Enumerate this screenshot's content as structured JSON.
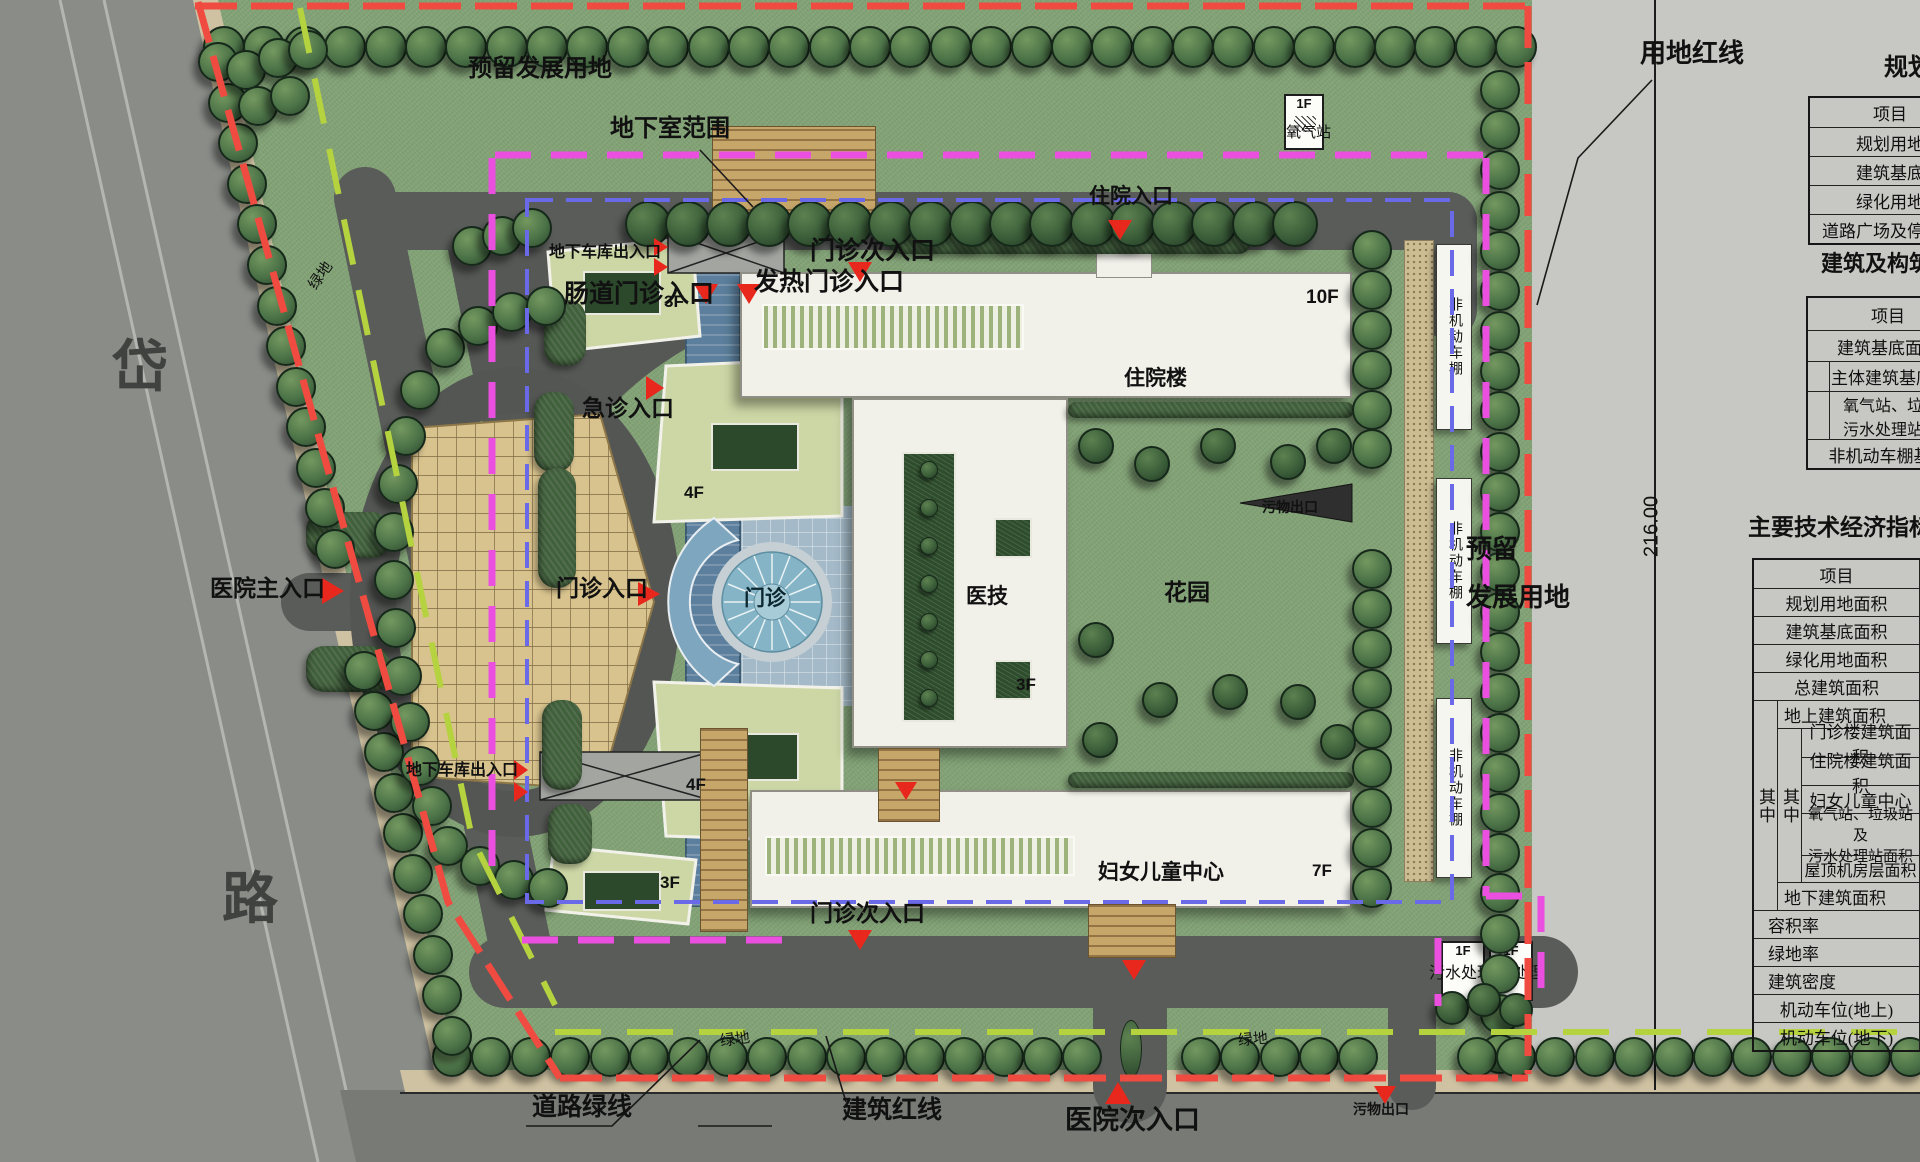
{
  "plan": {
    "road_name": {
      "char1": "岱",
      "char2": "路"
    },
    "boundary": {
      "reserved_top": "预留发展用地",
      "basement": "地下室范围",
      "red_line": "用地红线",
      "road_green_line": "道路绿线",
      "building_red_line": "建筑红线",
      "dimension": "216.00",
      "green_left": "绿地",
      "green_bottom_1": "绿地",
      "green_bottom_2": "绿地",
      "reserved_right_line1": "预留",
      "reserved_right_line2": "发展用地"
    },
    "entrances": {
      "main": "医院主入口",
      "outpatient": "门诊入口",
      "emergency": "急诊入口",
      "intestinal": "肠道门诊入口",
      "fever": "发热门诊入口",
      "outpatient_side_top": "门诊次入口",
      "outpatient_side_bottom": "门诊次入口",
      "inpatient": "住院入口",
      "secondary": "医院次入口",
      "garage_top": "地下车库出入口",
      "garage_left": "地下车库出入口",
      "waste_exit_mid": "污物出口",
      "waste_exit_bottom": "污物出口"
    },
    "buildings": {
      "inpatient": {
        "label": "住院楼",
        "floors": "10F"
      },
      "medtech": {
        "label": "医技",
        "floors": "3F"
      },
      "women_children": {
        "label": "妇女儿童中心",
        "floors": "7F"
      },
      "outpatient_hall": {
        "label": "门诊"
      },
      "garden": {
        "label": "花园"
      },
      "oxygen": {
        "label": "氧气站",
        "floors": "1F"
      },
      "sewage": {
        "label": "污水处理",
        "floors": "1F"
      },
      "waste": {
        "label": "污物处理",
        "floors": "1F"
      },
      "block_nw": {
        "floors": "3F"
      },
      "block_wn": {
        "floors": "4F"
      },
      "block_ws": {
        "floors": "4F"
      },
      "block_sw": {
        "floors": "3F"
      },
      "bike_shed": "非机动车棚"
    }
  },
  "tables": {
    "planning": {
      "title": "规划",
      "header": "项目",
      "rows": [
        "规划用地",
        "建筑基底",
        "绿化用地",
        "道路广场及停车场"
      ]
    },
    "structures": {
      "title": "建筑及构筑物",
      "header": "项目",
      "row_total": "建筑基底面积",
      "sub_main": "主体建筑基底面积",
      "sub_aux_line1": "氧气站、垃圾站",
      "sub_aux_line2": "污水处理站基底",
      "row_shed": "非机动车棚基底"
    },
    "indicators": {
      "title": "主要技术经济指标",
      "header": "项目",
      "qizhong": "其中",
      "r1": "规划用地面积",
      "r2": "建筑基底面积",
      "r3": "绿化用地面积",
      "r4": "总建筑面积",
      "r5": "地上建筑面积",
      "r6": "门诊楼建筑面积",
      "r7": "住院楼建筑面积",
      "r8": "妇女儿童中心",
      "r9a": "氧气站、垃圾站及",
      "r9b": "污水处理站面积",
      "r10": "屋顶机房层面积",
      "r11": "地下建筑面积",
      "r12": "容积率",
      "r13": "绿地率",
      "r14": "建筑密度",
      "r15": "机动车位(地上)",
      "r16": "机动车位(地下)"
    }
  }
}
